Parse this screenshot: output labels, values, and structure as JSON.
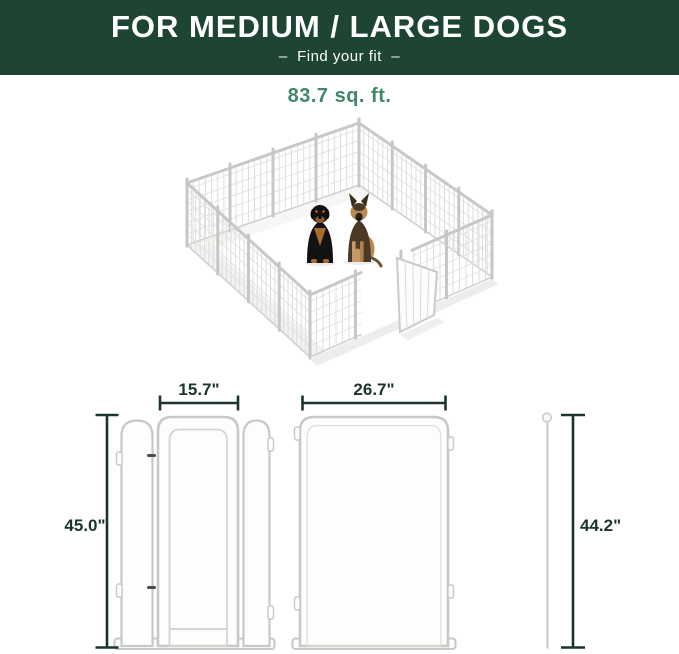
{
  "banner": {
    "title": "FOR MEDIUM / LARGE DOGS",
    "subtitle": "–  Find your fit  –"
  },
  "area": {
    "label": "83.7 sq. ft."
  },
  "illustration": {
    "type": "isometric-playpen",
    "dogs": [
      "rottweiler",
      "german-shepherd"
    ]
  },
  "dimensions": {
    "door_panel_width": "15.7\"",
    "door_panel_height": "45.0\"",
    "panel_width": "26.7\"",
    "stake_height": "44.2\""
  },
  "colors": {
    "banner_green": "#1e4434",
    "accent_green": "#40876a",
    "dimension_dark": "#1c352b",
    "pen_outline": "#c6c9c5",
    "text_white": "#ffffff"
  }
}
